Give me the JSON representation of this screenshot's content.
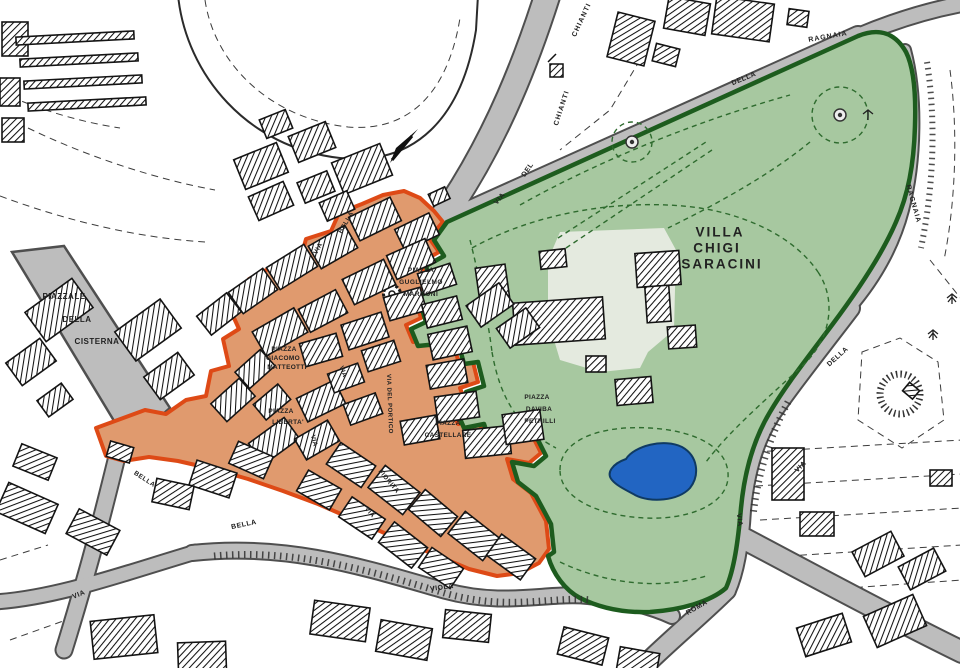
{
  "map": {
    "name": "town-plan-castelnuovo",
    "regions": {
      "historic_center": {
        "name": "historic-center-zone",
        "fill": "#e09a6e",
        "border": "#de4a16"
      },
      "park": {
        "name": "villa-chigi-saracini-park",
        "fill": "#a7c8a0",
        "border": "#1d5c1e"
      },
      "pond": {
        "fill": "#2265c2"
      },
      "road": {
        "fill": "#bdbdbd",
        "casing": "#4f4f4f"
      }
    }
  },
  "labels": [
    {
      "id": "villa-line1",
      "text": "VILLA",
      "x": 720,
      "y": 232,
      "rot": 0,
      "fs": 13.5,
      "ls": 2
    },
    {
      "id": "villa-line2",
      "text": "CHIGI",
      "x": 717,
      "y": 248,
      "rot": 0,
      "fs": 13.5,
      "ls": 2
    },
    {
      "id": "villa-line3",
      "text": "SARACINI",
      "x": 722,
      "y": 264,
      "rot": 0,
      "fs": 13.5,
      "ls": 2
    },
    {
      "id": "piazza-marconi-1",
      "text": "PIAZZA",
      "x": 421,
      "y": 271,
      "rot": 0,
      "fs": 6.5,
      "ls": 0.5
    },
    {
      "id": "piazza-marconi-2",
      "text": "GUGLIELMO",
      "x": 421,
      "y": 283,
      "rot": 0,
      "fs": 6.5,
      "ls": 0.5
    },
    {
      "id": "piazza-marconi-3",
      "text": "MARCONI",
      "x": 421,
      "y": 295,
      "rot": 0,
      "fs": 6.5,
      "ls": 0.5
    },
    {
      "id": "piazzale-cisterna-1",
      "text": "PIAZZALE",
      "x": 64,
      "y": 297,
      "rot": 0,
      "fs": 8,
      "ls": 0.5
    },
    {
      "id": "piazzale-cisterna-2",
      "text": "DELLA",
      "x": 77,
      "y": 320,
      "rot": 0,
      "fs": 8,
      "ls": 0.5
    },
    {
      "id": "piazzale-cisterna-3",
      "text": "CISTERNA",
      "x": 97,
      "y": 342,
      "rot": 0,
      "fs": 8,
      "ls": 0.5
    },
    {
      "id": "piazza-matteotti-1",
      "text": "PIAZZA",
      "x": 284,
      "y": 350,
      "rot": 0,
      "fs": 6.5,
      "ls": 0.3
    },
    {
      "id": "piazza-matteotti-2",
      "text": "GIACOMO",
      "x": 283,
      "y": 359,
      "rot": 0,
      "fs": 6.5,
      "ls": 0.3
    },
    {
      "id": "piazza-matteotti-3",
      "text": "MATTEOTTI",
      "x": 287,
      "y": 368,
      "rot": 0,
      "fs": 6.5,
      "ls": 0.3
    },
    {
      "id": "piazza-liberta-1",
      "text": "PIAZZA",
      "x": 281,
      "y": 412,
      "rot": 0,
      "fs": 6.5,
      "ls": 0.3
    },
    {
      "id": "piazza-liberta-2",
      "text": "LIBERTA'",
      "x": 288,
      "y": 423,
      "rot": 0,
      "fs": 6.5,
      "ls": 0.3
    },
    {
      "id": "piazza-castellare-1",
      "text": "PIAZZA",
      "x": 448,
      "y": 424,
      "rot": 0,
      "fs": 6.5,
      "ls": 0.3
    },
    {
      "id": "piazza-castellare-2",
      "text": "CASTELLARE",
      "x": 448,
      "y": 436,
      "rot": 0,
      "fs": 6.5,
      "ls": 0.3
    },
    {
      "id": "piazza-petrilli-1",
      "text": "PIAZZA",
      "x": 537,
      "y": 398,
      "rot": 0,
      "fs": 6.5,
      "ls": 0.3
    },
    {
      "id": "piazza-petrilli-2",
      "text": "DAVIBA",
      "x": 539,
      "y": 410,
      "rot": 0,
      "fs": 6.5,
      "ls": 0.3
    },
    {
      "id": "piazza-petrilli-3",
      "text": "PETRILLI",
      "x": 540,
      "y": 422,
      "rot": 0,
      "fs": 6.5,
      "ls": 0.3
    },
    {
      "id": "via-del-chianti-via",
      "text": "VIA",
      "x": 500,
      "y": 199,
      "rot": -50,
      "fs": 7,
      "ls": 0.5
    },
    {
      "id": "via-del-chianti-del",
      "text": "DEL",
      "x": 528,
      "y": 170,
      "rot": -55,
      "fs": 7,
      "ls": 0.5
    },
    {
      "id": "via-del-chianti-name",
      "text": "CHIANTI",
      "x": 562,
      "y": 108,
      "rot": -72,
      "fs": 7,
      "ls": 1.2
    },
    {
      "id": "via-del-chianti-top",
      "text": "CHIANTI",
      "x": 582,
      "y": 20,
      "rot": -65,
      "fs": 7,
      "ls": 1.2
    },
    {
      "id": "via-ragnaia-top",
      "text": "RAGNAIA",
      "x": 828,
      "y": 37,
      "rot": -10,
      "fs": 7,
      "ls": 1
    },
    {
      "id": "via-ragnaia-della",
      "text": "DELLA",
      "x": 744,
      "y": 79,
      "rot": -22,
      "fs": 7,
      "ls": 0.5
    },
    {
      "id": "via-ragnaia-right",
      "text": "RAGNAIA",
      "x": 913,
      "y": 204,
      "rot": 74,
      "fs": 7,
      "ls": 1
    },
    {
      "id": "via-ragnaia-della2",
      "text": "DELLA",
      "x": 838,
      "y": 357,
      "rot": -42,
      "fs": 7,
      "ls": 0.5
    },
    {
      "id": "via-right",
      "text": "VIA",
      "x": 801,
      "y": 467,
      "rot": -45,
      "fs": 7,
      "ls": 0.5
    },
    {
      "id": "via-roma-via",
      "text": "VIA",
      "x": 739,
      "y": 520,
      "rot": 83,
      "fs": 7,
      "ls": 0.5
    },
    {
      "id": "via-roma-name",
      "text": "ROMA",
      "x": 697,
      "y": 608,
      "rot": -30,
      "fs": 7,
      "ls": 0.5
    },
    {
      "id": "via-viola",
      "text": "VIOLA",
      "x": 442,
      "y": 588,
      "rot": -8,
      "fs": 7,
      "ls": 0.5
    },
    {
      "id": "via-bottom-left",
      "text": "VIA",
      "x": 79,
      "y": 595,
      "rot": -22,
      "fs": 7,
      "ls": 0.5
    },
    {
      "id": "via-bella-south",
      "text": "BELLA",
      "x": 244,
      "y": 525,
      "rot": -12,
      "fs": 7,
      "ls": 0.5
    },
    {
      "id": "via-bella-sw",
      "text": "BELLA",
      "x": 144,
      "y": 480,
      "rot": 33,
      "fs": 6.5,
      "ls": 0.5
    },
    {
      "id": "via-bella-nw-via",
      "text": "VIA",
      "x": 319,
      "y": 249,
      "rot": -60,
      "fs": 6.5,
      "ls": 0.5
    },
    {
      "id": "via-bella-nw",
      "text": "BELLA",
      "x": 347,
      "y": 223,
      "rot": -60,
      "fs": 6.5,
      "ls": 0.5
    },
    {
      "id": "via-del-portico",
      "text": "VIA DEL PORTICO",
      "x": 389,
      "y": 404,
      "rot": 88,
      "fs": 6,
      "ls": 0.5
    },
    {
      "id": "via-town-1",
      "text": "VIA",
      "x": 313,
      "y": 441,
      "rot": 76,
      "fs": 6.5,
      "ls": 0.3
    },
    {
      "id": "via-town-2",
      "text": "VIA",
      "x": 342,
      "y": 372,
      "rot": 70,
      "fs": 6.5,
      "ls": 0.3
    },
    {
      "id": "via-fiorita",
      "text": "FIORITA",
      "x": 388,
      "y": 482,
      "rot": 50,
      "fs": 6.5,
      "ls": 0.5
    },
    {
      "id": "via-fiorita-via",
      "text": "VIA",
      "x": 369,
      "y": 513,
      "rot": 48,
      "fs": 6.5,
      "ls": 0.3
    }
  ]
}
